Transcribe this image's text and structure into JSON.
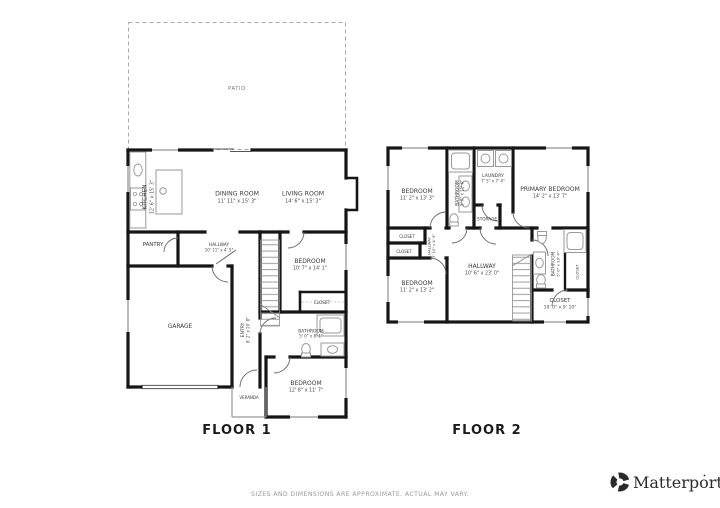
{
  "floor1": {
    "title": "FLOOR 1",
    "patio": {
      "name": "PATIO"
    },
    "kitchen": {
      "name": "KITCHEN",
      "dims": "12' 6\" x 15' 3\""
    },
    "dining_room": {
      "name": "DINING ROOM",
      "dims": "11' 11\" x 15' 3\""
    },
    "living_room": {
      "name": "LIVING ROOM",
      "dims": "14' 6\" x 15' 3\""
    },
    "pantry": {
      "name": "PANTRY"
    },
    "hallway": {
      "name": "HALLWAY",
      "dims": "10' 11\" x 4' 5\""
    },
    "bedroom_mid": {
      "name": "BEDROOM",
      "dims": "10' 7\" x 14' 1\""
    },
    "closet": {
      "name": "CLOSET"
    },
    "bathroom": {
      "name": "BATHROOM",
      "dims": "5' 0\" x 8' 1\""
    },
    "entry": {
      "name": "ENTRY",
      "dims": "8' 2\" x 20' 8\""
    },
    "garage": {
      "name": "GARAGE"
    },
    "veranda": {
      "name": "VERANDA"
    },
    "bedroom_bottom": {
      "name": "BEDROOM",
      "dims": "12' 8\" x 11' 7\""
    }
  },
  "floor2": {
    "title": "FLOOR 2",
    "bedroom_top": {
      "name": "BEDROOM",
      "dims": "11' 2\" x 13' 3\""
    },
    "bathroom_hall": {
      "name": "BATHROOM",
      "dims": "5' 0\" x 11' 6\""
    },
    "laundry": {
      "name": "LAUNDRY",
      "dims": "7' 5\" x 7' 4\""
    },
    "primary_bedroom": {
      "name": "PRIMARY BEDROOM",
      "dims": "14' 2\" x 13' 7\""
    },
    "storage": {
      "name": "STORAGE"
    },
    "closet_left_a": {
      "name": "CLOSET"
    },
    "closet_left_b": {
      "name": "CLOSET"
    },
    "hallway_small": {
      "name": "HALLWAY",
      "dims": "3' 10\" x 4' 9\""
    },
    "bedroom_bottom": {
      "name": "BEDROOM",
      "dims": "11' 2\" x 13' 2\""
    },
    "hallway": {
      "name": "HALLWAY",
      "dims": "10' 6\" x 23' 0\""
    },
    "bathroom_primary": {
      "name": "BATHROOM",
      "dims": "5' 0\" x 10' 4\""
    },
    "closet_small": {
      "name": "CLOSET"
    },
    "closet_large": {
      "name": "CLOSET",
      "dims": "10' 0\" x 9' 10\""
    }
  },
  "footer": {
    "disclaimer": "SIZES AND DIMENSIONS ARE APPROXIMATE. ACTUAL MAY VARY."
  },
  "branding": {
    "name": "Matterport",
    "logo_icon": "matterport-pinwheel-icon"
  },
  "colors": {
    "walls": "#161616",
    "labels": "#3a3a3a",
    "fixtures": "#9a9a9a",
    "footer_text": "#9a9a9a"
  }
}
